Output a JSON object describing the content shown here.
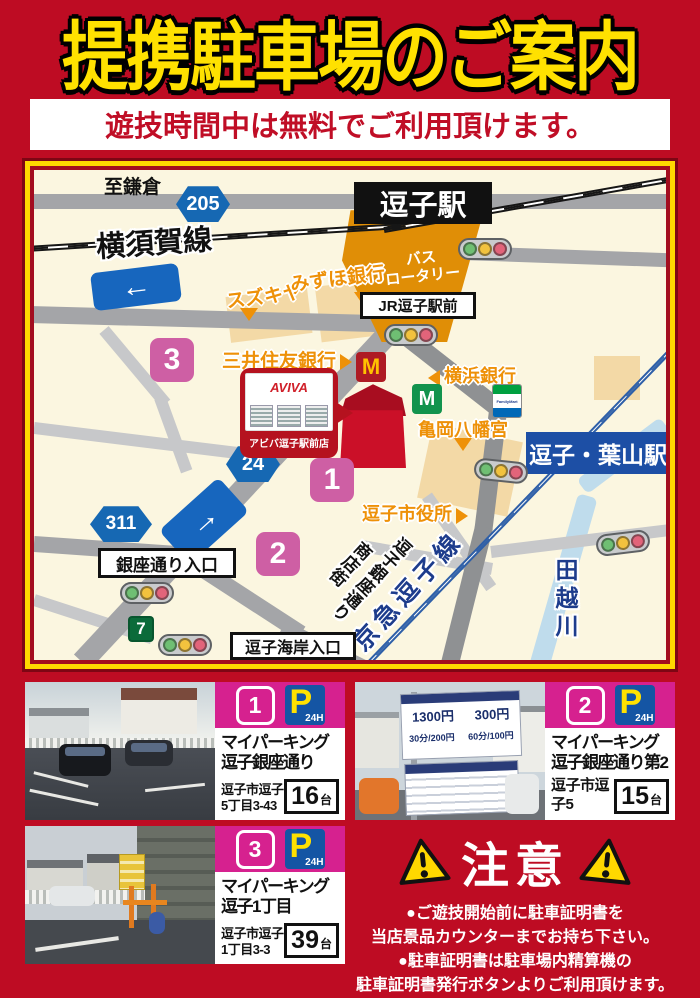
{
  "title": "提携駐車場のご案内",
  "subtitle": "遊技時間中は無料でご利用頂けます。",
  "colors": {
    "page_bg": "#BE0C23",
    "title_yellow": "#FFE100",
    "frame_yellow": "#FFD800",
    "map_bg": "#FBF6E0",
    "card_magenta": "#D6218F",
    "map_badge_pink": "#CE5FA4",
    "route_blue": "#1668B3",
    "station_orange": "#E08E06",
    "poi_orange": "#EE9108",
    "keikyu_blue": "#2E5FA8",
    "river_blue": "#BFDCEC",
    "p_sign_blue": "#1455A4"
  },
  "map": {
    "to_kamakura": "至鎌倉",
    "route_205": "205",
    "route_24": "24",
    "route_311": "311",
    "yokosuka_line": "横須賀線",
    "zushi_station": "逗子駅",
    "bus_rotary_line1": "バス",
    "bus_rotary_line2": "ロータリー",
    "jr_zushi_ekimae": "JR逗子駅前",
    "suzukiya": "スズキヤ",
    "mizuho_bank": "みずほ銀行",
    "smbc_bank": "三井住友銀行",
    "yokohama_bank": "横浜銀行",
    "kameoka_hachimangu": "亀岡八幡宮",
    "zushi_city_hall": "逗子市役所",
    "zushi_hayama_station": "逗子・葉山駅",
    "keikyu_zushi_line": "京急逗子線",
    "tagoe_river": "田越川",
    "ginza_street_line1": "逗子銀座通り",
    "ginza_street_line2": "商店街",
    "ginza_entrance": "銀座通り入口",
    "kaigan_entrance": "逗子海岸入口",
    "badge1": "1",
    "badge2": "2",
    "badge3": "3",
    "aviva_logo": "AVIVA",
    "aviva_store": "アビバ逗子駅前店",
    "mcdonalds_m": "M",
    "mos_m": "M",
    "seven": "7",
    "familymart": "FamilyMart"
  },
  "p_sign": {
    "p": "P",
    "hours": "24H"
  },
  "parkings": [
    {
      "num": "1",
      "name1": "マイパーキング",
      "name2": "逗子銀座通り",
      "addr1": "逗子市逗子",
      "addr2": "5丁目3-43",
      "capacity": "16",
      "unit": "台"
    },
    {
      "num": "2",
      "name1": "マイパーキング",
      "name2": "逗子銀座通り第2",
      "addr1": "逗子市逗子5",
      "addr2": "",
      "capacity": "15",
      "unit": "台",
      "sign_prices": [
        "1300円",
        "300円",
        "30分/200円",
        "60分/100円"
      ]
    },
    {
      "num": "3",
      "name1": "マイパーキング",
      "name2": "逗子1丁目",
      "addr1": "逗子市逗子",
      "addr2": "1丁目3-3",
      "capacity": "39",
      "unit": "台"
    }
  ],
  "notice": {
    "title": "注意",
    "line1": "●ご遊技開始前に駐車証明書を",
    "line2": "当店景品カウンターまでお持ち下さい。",
    "line3": "●駐車証明書は駐車場内精算機の",
    "line4": "駐車証明書発行ボタンよりご利用頂けます。"
  }
}
